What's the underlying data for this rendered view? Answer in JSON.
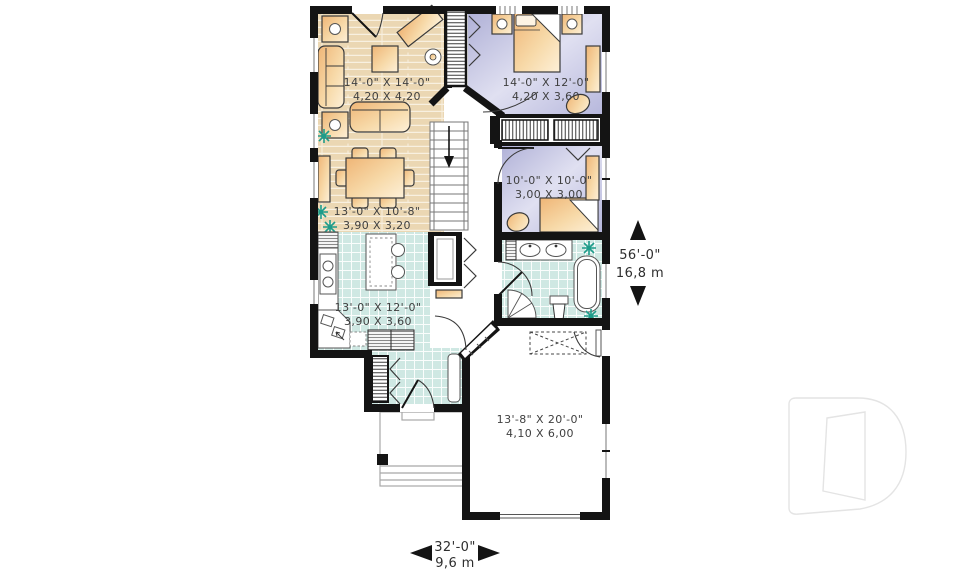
{
  "plan_labels": {
    "living": {
      "imperial": "14'-0\" X 14'-0\"",
      "metric": "4,20 X 4,20"
    },
    "master_bedroom": {
      "imperial": "14'-0\" X 12'-0\"",
      "metric": "4,20 X 3,60"
    },
    "bedroom_2": {
      "imperial": "10'-0\" X 10'-0\"",
      "metric": "3,00 X 3,00"
    },
    "dining": {
      "imperial": "13'-0\" X 10'-8\"",
      "metric": "3,90 X 3,20"
    },
    "kitchen": {
      "imperial": "13'-0\" X 12'-0\"",
      "metric": "3,90 X 3,60"
    },
    "garage": {
      "imperial": "13'-8\" X 20'-0\"",
      "metric": "4,10 X 6,00"
    }
  },
  "overall_dimensions": {
    "depth_imperial": "56'-0\"",
    "depth_metric": "16,8 m",
    "width_imperial": "32'-0\"",
    "width_metric": "9,6 m"
  },
  "watermark_letter": "D",
  "colors": {
    "wall": "#141414",
    "wood_floor": "#ebd7b3",
    "tile_floor": "#cfe8e3",
    "bedroom_floor": "#b4b5da",
    "furniture": "#f5c98b",
    "plant": "#1f9c8a",
    "label_text": "#3f3f3f",
    "watermark_outline": "#e4e4e4"
  }
}
